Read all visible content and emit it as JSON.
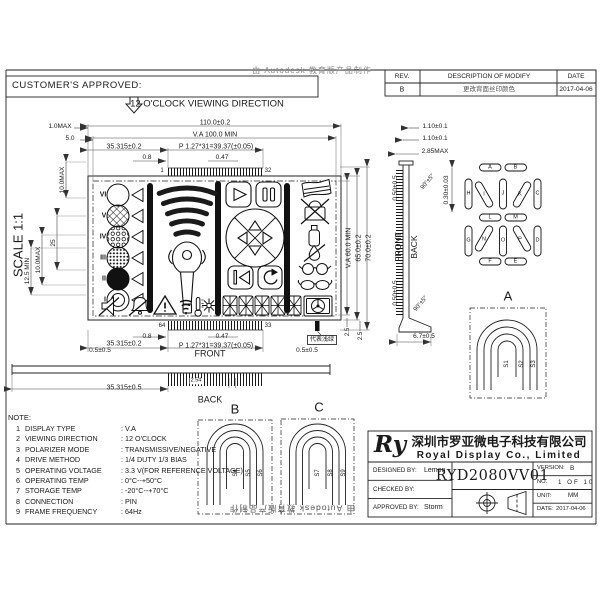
{
  "header": {
    "customer_approved": "CUSTOMER'S APPROVED:"
  },
  "revision_table": {
    "rev_header": "REV.",
    "desc_header": "DESCRIPTION OF MODIFY",
    "date_header": "DATE",
    "rows": [
      {
        "rev": "B",
        "description": "更改背面丝印颜色",
        "date": "2017-04-06"
      }
    ]
  },
  "watermark": {
    "top": "由 Autodesk 教育版产品制作",
    "bottom": "由 Autodesk 教育版产品制作"
  },
  "notes": {
    "title": "NOTE:",
    "items": [
      {
        "no": "1",
        "name": "DISPLAY TYPE",
        "value": ": V.A"
      },
      {
        "no": "2",
        "name": "VIEWING DIRECTION",
        "value": ": 12 O'CLOCK"
      },
      {
        "no": "3",
        "name": "POLARIZER MODE",
        "value": ": TRANSMISSIVE/NEGATIVE"
      },
      {
        "no": "4",
        "name": "DRIVE METHOD",
        "value": ": 1/4 DUTY  1/3 BIAS"
      },
      {
        "no": "5",
        "name": "OPERATING VOLTAGE",
        "value": ": 3.3 V(FOR REFERENCE VOLTAGE)"
      },
      {
        "no": "6",
        "name": "OPERATING TEMP",
        "value": ": 0°C--+50°C"
      },
      {
        "no": "7",
        "name": "STORAGE TEMP",
        "value": ": -20°C--+70°C"
      },
      {
        "no": "8",
        "name": "CONNECTION",
        "value": ": PIN"
      },
      {
        "no": "9",
        "name": "FRAME FREQUENCY",
        "value": ": 64Hz"
      }
    ]
  },
  "title_block": {
    "logo": "Ry",
    "company_cn": "深圳市罗亚微电子科技有限公司",
    "company_en": "Royal Display Co., Limited",
    "designed_label": "DESIGNED BY:",
    "designed_value": "Lemon",
    "checked_label": "CHECKED BY:",
    "checked_value": "",
    "approved_label": "APPROVED BY:",
    "approved_value": "Storm",
    "part_number": "RYD2080VV01",
    "version_label": "VERSION:",
    "version_value": "B",
    "no_label": "NO.",
    "no_value": "1 OF 10",
    "unit_label": "UNIT:",
    "unit_value": "MM",
    "date_label": "DATE:",
    "date_value": "2017-04-06"
  },
  "labels": [
    {
      "id": "viewing-direction",
      "t": "12 O'CLOCK VIEWING DIRECTION",
      "x": 207,
      "y": 104,
      "fs": 9.5
    },
    {
      "id": "scale-text",
      "t": "SCALE 1:1",
      "x": 18,
      "y": 245,
      "fs": 13,
      "r": -90
    },
    {
      "id": "dim-110",
      "t": "110.0±0.2",
      "x": 215,
      "y": 123,
      "fs": 7
    },
    {
      "id": "dim-va100",
      "t": "V.A 100.0 MIN",
      "x": 215,
      "y": 135,
      "fs": 7
    },
    {
      "id": "dim-35315-top",
      "t": "35.315±0.2",
      "x": 124,
      "y": 147,
      "fs": 7
    },
    {
      "id": "dim-p127-top",
      "t": "P 1.27*31=39.37(±0.05)",
      "x": 216,
      "y": 147,
      "fs": 7
    },
    {
      "id": "dim-08-top",
      "t": "0.8",
      "x": 147,
      "y": 158,
      "fs": 6.5
    },
    {
      "id": "dim-047-top",
      "t": "0.47",
      "x": 222,
      "y": 158,
      "fs": 6.5
    },
    {
      "id": "pin-1",
      "t": "1",
      "x": 162,
      "y": 171,
      "fs": 6
    },
    {
      "id": "pin-32",
      "t": "32",
      "x": 268,
      "y": 171,
      "fs": 6
    },
    {
      "id": "dim-10max",
      "t": "1.0MAX",
      "x": 60,
      "y": 127,
      "fs": 6.5
    },
    {
      "id": "dim-50",
      "t": "5.0",
      "x": 70,
      "y": 139,
      "fs": 6.5
    },
    {
      "id": "dim-100max-a",
      "t": "10.0MAX",
      "x": 63,
      "y": 180,
      "fs": 6.5,
      "r": -90
    },
    {
      "id": "dim-25",
      "t": "25",
      "x": 54,
      "y": 243,
      "fs": 6.5,
      "r": -90
    },
    {
      "id": "dim-100max-b",
      "t": "10.0MAX",
      "x": 39,
      "y": 260,
      "fs": 6.5,
      "r": -90
    },
    {
      "id": "dim-125min",
      "t": "12.5 MIN",
      "x": 28,
      "y": 271,
      "fs": 6.5,
      "r": -90
    },
    {
      "id": "roman-6",
      "t": "VI",
      "x": 103,
      "y": 195,
      "fs": 7,
      "b": 1
    },
    {
      "id": "roman-5",
      "t": "V",
      "x": 104,
      "y": 216,
      "fs": 7,
      "b": 1
    },
    {
      "id": "roman-4",
      "t": "IV",
      "x": 103,
      "y": 237,
      "fs": 7,
      "b": 1
    },
    {
      "id": "roman-3",
      "t": "III",
      "x": 103,
      "y": 258,
      "fs": 7,
      "b": 1
    },
    {
      "id": "roman-2",
      "t": "II",
      "x": 104,
      "y": 279,
      "fs": 7,
      "b": 1
    },
    {
      "id": "roman-1",
      "t": "I",
      "x": 105,
      "y": 300,
      "fs": 7,
      "b": 1
    },
    {
      "id": "mark-1",
      "t": "1",
      "x": 218,
      "y": 299,
      "fs": 5.5
    },
    {
      "id": "mark-2",
      "t": "2",
      "x": 218,
      "y": 309,
      "fs": 5.5
    },
    {
      "id": "dim-va60",
      "t": "V.A 60.0 MIN",
      "x": 349,
      "y": 248,
      "fs": 7,
      "r": -90
    },
    {
      "id": "dim-65",
      "t": "65.0±0.2",
      "x": 359,
      "y": 248,
      "fs": 7,
      "r": -90
    },
    {
      "id": "dim-70",
      "t": "70.0±0.2",
      "x": 369,
      "y": 248,
      "fs": 7,
      "r": -90
    },
    {
      "id": "dim-25c",
      "t": "2.5",
      "x": 348,
      "y": 332,
      "fs": 6,
      "r": -90
    },
    {
      "id": "dim-25d",
      "t": "2.5",
      "x": 361,
      "y": 336,
      "fs": 6,
      "r": -90
    },
    {
      "id": "pin-64",
      "t": "64",
      "x": 162,
      "y": 326,
      "fs": 6
    },
    {
      "id": "pin-33",
      "t": "33",
      "x": 268,
      "y": 326,
      "fs": 6
    },
    {
      "id": "dim-08-bot",
      "t": "0.8",
      "x": 147,
      "y": 337,
      "fs": 6.5
    },
    {
      "id": "dim-047-bot",
      "t": "0.47",
      "x": 222,
      "y": 337,
      "fs": 6.5
    },
    {
      "id": "dim-35315-bot",
      "t": "35.315±0.2",
      "x": 124,
      "y": 344,
      "fs": 7
    },
    {
      "id": "dim-p127-bot",
      "t": "P 1.27*31=39.37(±0.05)",
      "x": 216,
      "y": 346,
      "fs": 7
    },
    {
      "id": "marker-note",
      "t": "代表浅绿",
      "x": 322,
      "y": 340,
      "fs": 6,
      "boxed": 1
    },
    {
      "id": "front-label",
      "t": "FRONT",
      "x": 210,
      "y": 354,
      "fs": 9
    },
    {
      "id": "dim-05-left",
      "t": "0.5±0.5",
      "x": 100,
      "y": 351,
      "fs": 6.5
    },
    {
      "id": "dim-05-right",
      "t": "0.5±0.5",
      "x": 307,
      "y": 351,
      "fs": 6.5
    },
    {
      "id": "dim-35315-side",
      "t": "35.315±0.5",
      "x": 124,
      "y": 388,
      "fs": 7
    },
    {
      "id": "dim-254",
      "t": "2.54",
      "x": 196,
      "y": 381,
      "fs": 5.5,
      "bg": 1
    },
    {
      "id": "back-label",
      "t": "BACK",
      "x": 210,
      "y": 400,
      "fs": 9
    },
    {
      "id": "detail-b-title",
      "t": "B",
      "x": 235,
      "y": 409,
      "fs": 13
    },
    {
      "id": "detail-c-title",
      "t": "C",
      "x": 319,
      "y": 407,
      "fs": 13
    },
    {
      "id": "seg-s4",
      "t": "S4",
      "x": 236,
      "y": 473,
      "fs": 6,
      "r": -90
    },
    {
      "id": "seg-s5",
      "t": "S5",
      "x": 248.5,
      "y": 473,
      "fs": 6,
      "r": -90
    },
    {
      "id": "seg-s6",
      "t": "S6",
      "x": 261,
      "y": 473,
      "fs": 6,
      "r": -90
    },
    {
      "id": "seg-s7",
      "t": "S7",
      "x": 318,
      "y": 473,
      "fs": 6,
      "r": -90
    },
    {
      "id": "seg-s8",
      "t": "S8",
      "x": 331,
      "y": 473,
      "fs": 6,
      "r": -90
    },
    {
      "id": "seg-s9",
      "t": "S9",
      "x": 343.5,
      "y": 473,
      "fs": 6,
      "r": -90
    },
    {
      "id": "dim-110p-a",
      "t": "1.10±0.1",
      "x": 435,
      "y": 127,
      "fs": 6.5
    },
    {
      "id": "dim-110p-b",
      "t": "1.10±0.1",
      "x": 435,
      "y": 139,
      "fs": 6.5
    },
    {
      "id": "dim-285max",
      "t": "2.85MAX",
      "x": 435,
      "y": 152,
      "fs": 6.5
    },
    {
      "id": "dim-90-top",
      "t": "90°±5°",
      "x": 428,
      "y": 182,
      "fs": 6,
      "r": -50
    },
    {
      "id": "dim-030",
      "t": "0.30±0.03",
      "x": 447,
      "y": 190,
      "fs": 6.5,
      "r": -90
    },
    {
      "id": "dim-050-top",
      "t": "0.50±0.5",
      "x": 396,
      "y": 188,
      "fs": 6.5,
      "r": -90
    },
    {
      "id": "front-side",
      "t": "FRONT",
      "x": 398,
      "y": 247,
      "fs": 8.5,
      "r": -90
    },
    {
      "id": "back-side",
      "t": "BACK",
      "x": 414,
      "y": 247,
      "fs": 8.5,
      "r": -90
    },
    {
      "id": "dim-050-bot",
      "t": "0.50±0.5",
      "x": 396,
      "y": 293,
      "fs": 6.5,
      "r": -90
    },
    {
      "id": "dim-90-bot",
      "t": "90°±5°",
      "x": 421,
      "y": 304,
      "fs": 6,
      "r": -50
    },
    {
      "id": "dim-67",
      "t": "6.7±0.5",
      "x": 424,
      "y": 337,
      "fs": 6.5
    },
    {
      "id": "detail-a-title",
      "t": "A",
      "x": 508,
      "y": 296,
      "fs": 13
    },
    {
      "id": "seg-s1",
      "t": "S1",
      "x": 507,
      "y": 364,
      "fs": 6,
      "r": -90
    },
    {
      "id": "seg-s2",
      "t": "S2",
      "x": 521.5,
      "y": 364,
      "fs": 6,
      "r": -90
    },
    {
      "id": "seg-s3",
      "t": "S3",
      "x": 534,
      "y": 364,
      "fs": 6,
      "r": -90
    },
    {
      "id": "seg-a",
      "t": "A",
      "x": 490,
      "y": 167.5,
      "fs": 5.5
    },
    {
      "id": "seg-b",
      "t": "B",
      "x": 515.5,
      "y": 167.5,
      "fs": 5.5
    },
    {
      "id": "seg-h",
      "t": "H",
      "x": 468.5,
      "y": 194,
      "fs": 5.5
    },
    {
      "id": "seg-i",
      "t": "I",
      "x": 484,
      "y": 194.5,
      "fs": 5.5
    },
    {
      "id": "seg-j",
      "t": "J",
      "x": 503,
      "y": 194,
      "fs": 5.5
    },
    {
      "id": "seg-k",
      "t": "K",
      "x": 520,
      "y": 194.5,
      "fs": 5.5
    },
    {
      "id": "seg-c",
      "t": "C",
      "x": 537.5,
      "y": 194,
      "fs": 5.5
    },
    {
      "id": "seg-l",
      "t": "L",
      "x": 490,
      "y": 217.5,
      "fs": 5.5
    },
    {
      "id": "seg-m",
      "t": "M",
      "x": 515.5,
      "y": 217.5,
      "fs": 5.5
    },
    {
      "id": "seg-g",
      "t": "G",
      "x": 468.5,
      "y": 241,
      "fs": 5.5
    },
    {
      "id": "seg-n",
      "t": "N",
      "x": 484,
      "y": 239.5,
      "fs": 5.5
    },
    {
      "id": "seg-o",
      "t": "O",
      "x": 503,
      "y": 241,
      "fs": 5.5
    },
    {
      "id": "seg-p",
      "t": "P",
      "x": 520,
      "y": 239.5,
      "fs": 5.5
    },
    {
      "id": "seg-d",
      "t": "D",
      "x": 537.5,
      "y": 241,
      "fs": 5.5
    },
    {
      "id": "seg-f",
      "t": "F",
      "x": 490,
      "y": 261.5,
      "fs": 5.5
    },
    {
      "id": "seg-e",
      "t": "E",
      "x": 515.5,
      "y": 261.5,
      "fs": 5.5
    }
  ]
}
